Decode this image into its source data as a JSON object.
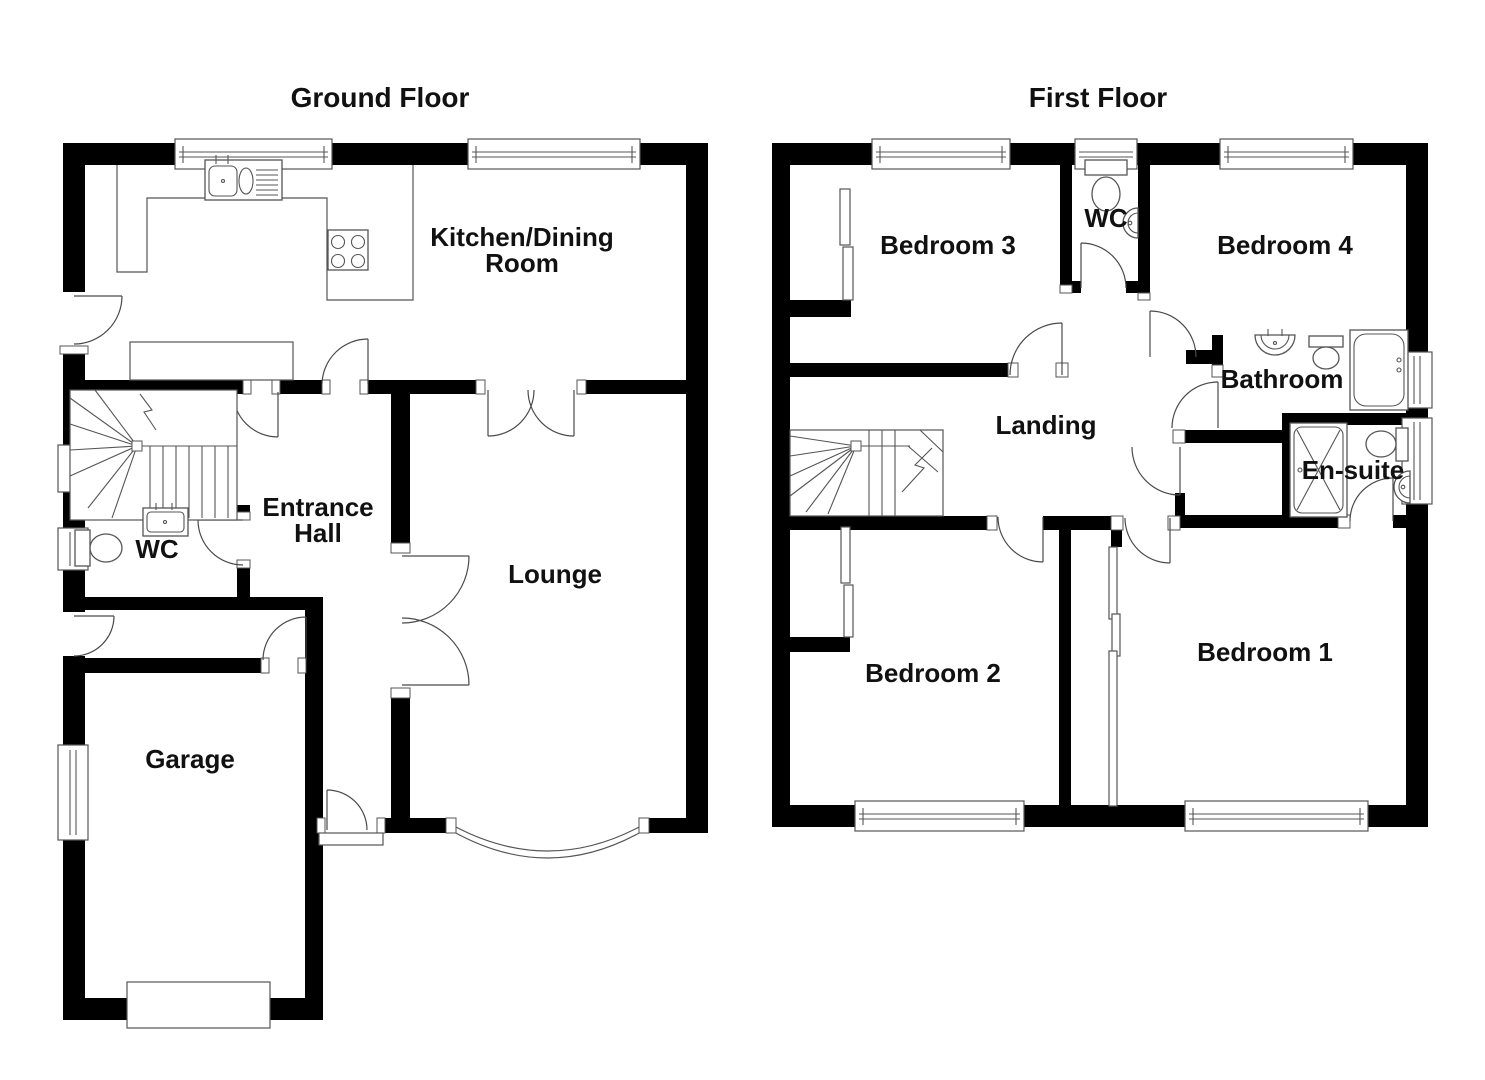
{
  "colors": {
    "wall": "#000000",
    "line": "#555555",
    "background": "#ffffff",
    "text": "#111111"
  },
  "ground_floor": {
    "title": "Ground Floor",
    "rooms": {
      "kitchen_dining": {
        "line1": "Kitchen/Dining",
        "line2": "Room"
      },
      "entrance_hall": {
        "line1": "Entrance",
        "line2": "Hall"
      },
      "wc": {
        "label": "WC"
      },
      "lounge": {
        "label": "Lounge"
      },
      "garage": {
        "label": "Garage"
      }
    }
  },
  "first_floor": {
    "title": "First Floor",
    "rooms": {
      "bedroom3": {
        "label": "Bedroom 3"
      },
      "wc": {
        "label": "WC"
      },
      "bedroom4": {
        "label": "Bedroom 4"
      },
      "bathroom": {
        "label": "Bathroom"
      },
      "landing": {
        "label": "Landing"
      },
      "ensuite": {
        "label": "En-suite"
      },
      "bedroom2": {
        "label": "Bedroom 2"
      },
      "bedroom1": {
        "label": "Bedroom 1"
      }
    }
  }
}
